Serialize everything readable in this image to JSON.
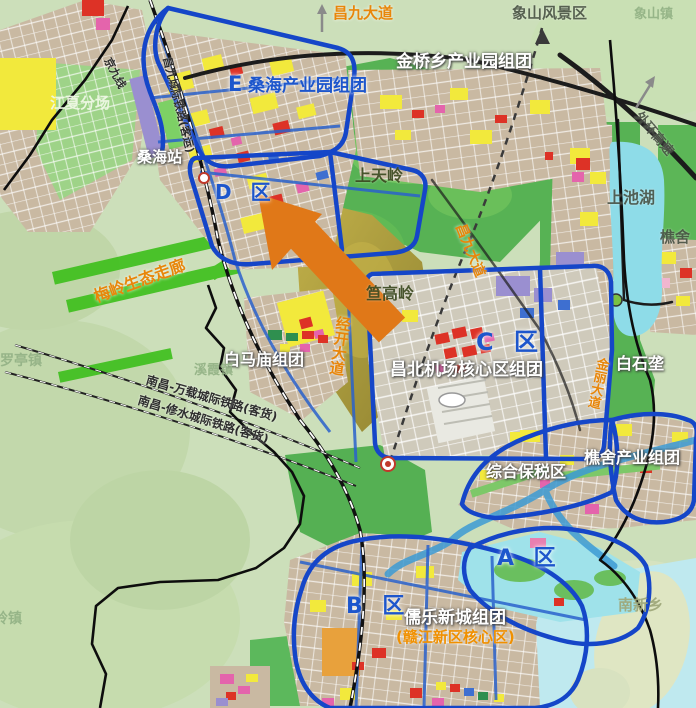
{
  "labels": {
    "changjiu_avenue_top": "昌九大道",
    "xiangshan_scenic_area": "象山风景区",
    "xiangshan_town": "象山镇",
    "jinqiao_industrial_park": "金桥乡产业园组团",
    "zone_e_letter": "E",
    "sanghai_industrial_park": "桑海产业园组团",
    "jiangxia_branch": "江夏分场",
    "jingjiu_railway": "京九线",
    "changjiu_intercity_railway": "昌九城际铁路(客运)",
    "sanghai_station": "桑海站",
    "zone_d": "D 区",
    "shangtianling": "上天岭",
    "shangchi_lake": "上池湖",
    "qiaoshe_town": "樵舍",
    "outer_ring_expressway": "外环高速",
    "changjiu_avenue_mid": "昌九大道",
    "meiling_eco_corridor": "梅岭生态走廊",
    "dagaoling": "笪高岭",
    "jingkai_avenue": "经开大道",
    "baimamiao_cluster": "白马庙组团",
    "zone_c": "C 区",
    "changbei_airport_core": "昌北机场核心区组团",
    "baishilong": "白石垄",
    "jinli_avenue": "金丽大道",
    "xixia_town": "溪霞镇",
    "luoting_town": "罗亭镇",
    "nanchang_wanzai_railway": "南昌-万载城际铁路(客货)",
    "nanchang_xiushui_railway": "南昌-修水城际铁路(客货)",
    "comprehensive_bonded_zone": "综合保税区",
    "qiaoshe_industrial_cluster": "樵舍产业组团",
    "zone_a": "A 区",
    "zone_b": "B 区",
    "rulexincheng_cluster": "儒乐新城组团",
    "ganjiang_new_area_core": "(赣江新区核心区)",
    "nanxin_township": "南新乡",
    "ling_town": "岭镇"
  },
  "colors": {
    "district_boundary_blue": "#1546c8",
    "zone_label_blue": "#1d56cc",
    "road_label_orange": "#e8860a",
    "forest_green": "#57b254",
    "corridor_green": "#3fc01e",
    "urban_tan": "#c9b9a2",
    "lake_cyan": "#8edce8",
    "river_pale_cyan": "#bfe9ef",
    "parcel_yellow": "#f2e93c",
    "parcel_red": "#dd3226",
    "parcel_magenta": "#e464ac",
    "parcel_purple": "#9a8fd0",
    "arrow_orange": "#e07818",
    "mountain_olive": "#b3a23b"
  }
}
